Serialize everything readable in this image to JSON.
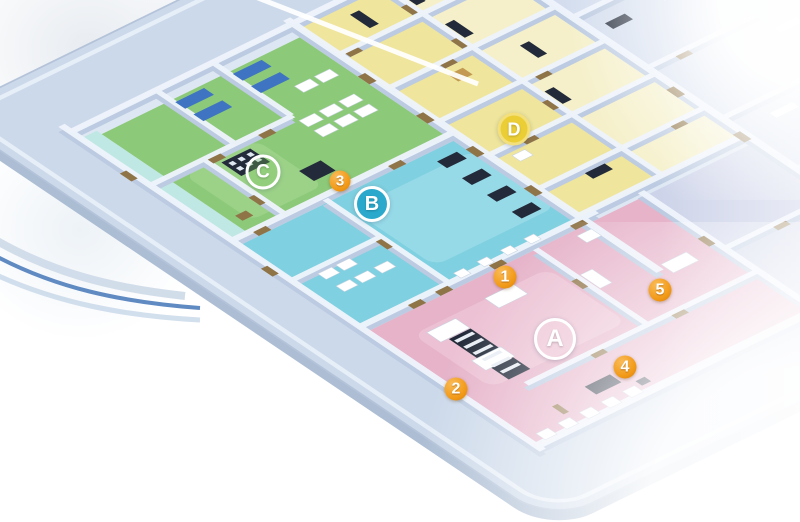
{
  "palette": {
    "page_bg": "#ffffff",
    "platform": "#ccd9ea",
    "platform_edge": "#9fb3cd",
    "platform_stroke": "#b4c3d9",
    "platform_inner_line": "#e9f0f8",
    "floor_base": "#dde7f3",
    "floor_right": "#d3ddee",
    "floor_teal_strip": "#bfe8e4",
    "wall_base": "#bccbe1",
    "wall_top": "#edf3fb",
    "zone_green": "#8cc979",
    "zone_green_light": "#a8d996",
    "zone_cyan": "#7fd0e0",
    "zone_cyan_light": "#a9e2ee",
    "zone_pink": "#e6b3c9",
    "zone_pink_light": "#f0cadb",
    "zone_yellow": "#efe59c",
    "zone_yellow_light": "#f5f0c9",
    "zone_lavender": "#cdd3e9",
    "furniture_dark": "#232b3a",
    "furniture_white": "#ffffff",
    "bed_blue": "#3e74c2",
    "door_wood": "#8f7448",
    "cabinet_tan": "#c49a52",
    "tread_light": "#e8edf4",
    "arc_blue": "#5f8ac2",
    "arc_light": "#c3d4e7",
    "arc_pale": "#cdd9e8",
    "white_line": "#ffffff"
  },
  "markers": {
    "zones": [
      {
        "label": "C",
        "fill": "rgba(125,200,95,0.30)",
        "ring": "#ffffff"
      },
      {
        "label": "B",
        "fill": "#2aa9cc",
        "ring": "#ffffff"
      },
      {
        "label": "D",
        "fill": "#ebce35",
        "ring": "#f3e07c"
      },
      {
        "label": "A",
        "fill": "rgba(245,220,230,0.30)",
        "ring": "#ffffff"
      }
    ],
    "rooms": [
      {
        "label": "1"
      },
      {
        "label": "2"
      },
      {
        "label": "3"
      },
      {
        "label": "4"
      },
      {
        "label": "5"
      }
    ],
    "room_marker_color": "#f29a18",
    "room_marker_edge": "#d97f08"
  }
}
